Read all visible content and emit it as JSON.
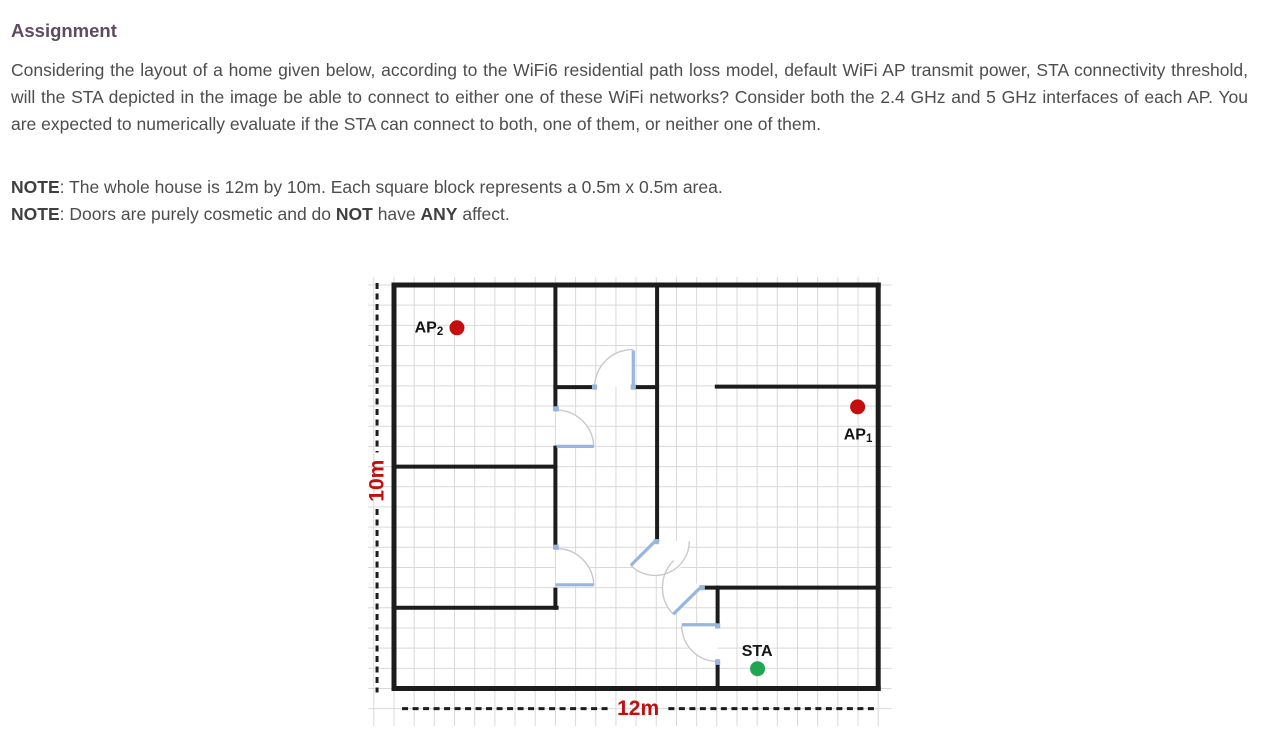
{
  "doc": {
    "heading": "Assignment",
    "paragraph": "Considering the layout of a home given below, according to the WiFi6 residential path loss model, default WiFi AP transmit power, STA connectivity threshold, will the STA depicted in the image be able to connect to either one of these WiFi networks? Consider both the 2.4 GHz and 5 GHz interfaces of each AP. You are expected to numerically evaluate if the STA can connect to both, one of them, or neither one of them.",
    "notes": [
      {
        "segments": [
          {
            "text": "NOTE",
            "bold": true
          },
          {
            "text": ": The whole house is 12m by 10m. Each square block represents a 0.5m x 0.5m area.",
            "bold": false
          }
        ]
      },
      {
        "segments": [
          {
            "text": "NOTE",
            "bold": true
          },
          {
            "text": ": Doors are purely cosmetic and do ",
            "bold": false
          },
          {
            "text": "NOT",
            "bold": true
          },
          {
            "text": " have ",
            "bold": false
          },
          {
            "text": "ANY",
            "bold": true
          },
          {
            "text": " affect.",
            "bold": false
          }
        ]
      }
    ]
  },
  "floorplan": {
    "house_width_m": 12,
    "house_height_m": 10,
    "cell_m": 0.5,
    "px_per_m": 40.35,
    "svg_origin": [
      42,
      15
    ],
    "colors": {
      "wall": "#1c1c1c",
      "grid": "#d9d9d9",
      "door_leaf": "#97b6df",
      "door_arc": "#c9c9c9",
      "dim": "#1c1c1c",
      "dim_label": "#c40e0e",
      "ap": "#c40e0e",
      "sta": "#1ea750",
      "label": "#141414"
    },
    "grid": {
      "x_from": -0.64,
      "x_to": 12.33,
      "y_from": -0.2,
      "y_to": 10.93,
      "step": 0.5
    },
    "walls": [
      [
        0,
        0,
        12,
        0,
        5
      ],
      [
        12,
        0,
        12,
        10,
        5
      ],
      [
        0,
        10,
        12,
        10,
        5
      ],
      [
        0,
        0,
        0,
        10,
        5
      ],
      [
        4.0,
        0,
        4.0,
        3.07,
        4
      ],
      [
        4.0,
        4.03,
        4.0,
        6.5,
        4
      ],
      [
        4.0,
        7.55,
        4.0,
        8.0,
        4
      ],
      [
        4.0,
        2.53,
        4.97,
        2.53,
        4
      ],
      [
        5.93,
        2.53,
        6.52,
        2.53,
        4
      ],
      [
        8.0,
        2.52,
        12,
        2.52,
        4
      ],
      [
        6.52,
        0,
        6.52,
        6.32,
        4
      ],
      [
        0,
        4.5,
        4.0,
        4.5,
        4
      ],
      [
        0,
        8.0,
        4.03,
        8.0,
        4
      ],
      [
        7.62,
        7.5,
        12,
        7.5,
        4
      ],
      [
        8.02,
        7.5,
        8.02,
        8.45,
        4
      ],
      [
        8.02,
        9.33,
        8.02,
        10,
        4
      ]
    ],
    "doors": [
      {
        "id": "door-top-hall",
        "hinge": [
          5.93,
          2.53
        ],
        "arc_from": [
          4.97,
          2.53
        ],
        "arc_to": [
          5.93,
          1.6
        ],
        "r": 0.94,
        "sweep": 1,
        "leaf": [
          5.93,
          2.5,
          5.93,
          1.62
        ],
        "ticks": [
          [
            4.97,
            2.53
          ],
          [
            5.93,
            2.53
          ]
        ]
      },
      {
        "id": "door-left-upper",
        "hinge": [
          4.02,
          4.02
        ],
        "arc_from": [
          4.02,
          3.1
        ],
        "arc_to": [
          4.95,
          4.02
        ],
        "r": 0.93,
        "sweep": 1,
        "leaf": [
          4.03,
          4.0,
          4.95,
          4.0
        ],
        "ticks": [
          [
            4.02,
            3.07
          ]
        ]
      },
      {
        "id": "door-left-lower",
        "hinge": [
          4.02,
          7.45
        ],
        "arc_from": [
          4.02,
          6.53
        ],
        "arc_to": [
          4.95,
          7.45
        ],
        "r": 0.93,
        "sweep": 1,
        "leaf": [
          4.0,
          7.43,
          4.95,
          7.43
        ],
        "ticks": [
          [
            4.02,
            6.5
          ]
        ]
      },
      {
        "id": "door-hall-center",
        "hinge": [
          6.47,
          6.35
        ],
        "arc_from": [
          5.87,
          6.95
        ],
        "arc_to": [
          7.32,
          6.35
        ],
        "r": 0.85,
        "sweep": 0,
        "leaf": [
          6.47,
          6.35,
          5.87,
          6.95
        ],
        "ticks": [
          [
            6.5,
            6.36
          ]
        ]
      },
      {
        "id": "door-hall-lower",
        "hinge": [
          7.6,
          7.5
        ],
        "arc_from": [
          6.92,
          8.16
        ],
        "arc_to": [
          6.93,
          6.83
        ],
        "r": 0.95,
        "sweep": 1,
        "leaf": [
          7.57,
          7.52,
          6.92,
          8.16
        ],
        "ticks": [
          [
            7.64,
            7.5
          ]
        ]
      },
      {
        "id": "door-sta-room",
        "hinge": [
          8.02,
          8.45
        ],
        "arc_from": [
          7.13,
          8.45
        ],
        "arc_to": [
          8.02,
          9.33
        ],
        "r": 0.89,
        "sweep": 0,
        "leaf": [
          7.13,
          8.42,
          8.0,
          8.42
        ],
        "ticks": [
          [
            8.02,
            8.45
          ],
          [
            8.02,
            9.35
          ]
        ]
      }
    ],
    "devices": [
      {
        "id": "AP2",
        "label": "AP",
        "sub": "2",
        "dot": [
          1.56,
          1.06
        ],
        "dot_r_px": 7.5,
        "color_key": "ap",
        "label_pos": [
          1.22,
          1.07
        ],
        "anchor": "end"
      },
      {
        "id": "AP1",
        "label": "AP",
        "sub": "1",
        "dot": [
          11.49,
          3.02
        ],
        "dot_r_px": 7.5,
        "color_key": "ap",
        "label_pos": [
          11.5,
          3.72
        ],
        "anchor": "middle"
      },
      {
        "id": "STA",
        "label": "STA",
        "sub": "",
        "dot": [
          9.01,
          9.51
        ],
        "dot_r_px": 7.5,
        "color_key": "sta",
        "label_pos": [
          9.0,
          9.08
        ],
        "anchor": "middle"
      }
    ],
    "dimensions": [
      {
        "id": "height",
        "label": "10m",
        "orient": "v",
        "at": -0.42,
        "from": -0.05,
        "to": 10.1,
        "gap": [
          4.15,
          5.55
        ],
        "label_at": 4.85
      },
      {
        "id": "width",
        "label": "12m",
        "orient": "h",
        "at": 10.5,
        "from": 0.2,
        "to": 11.97,
        "gap": [
          5.3,
          6.8
        ],
        "label_at": 6.05
      }
    ]
  }
}
